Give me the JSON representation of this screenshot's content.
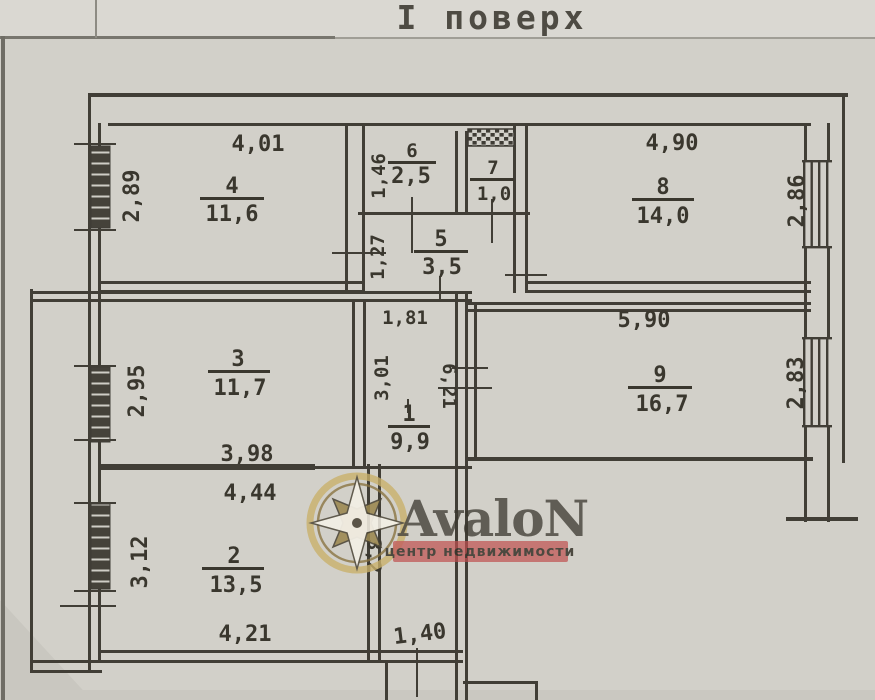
{
  "title": "І поверх",
  "floorplan": {
    "rooms": {
      "r1": {
        "num": "1",
        "area": "9,9"
      },
      "r2": {
        "num": "2",
        "area": "13,5"
      },
      "r3": {
        "num": "3",
        "area": "11,7"
      },
      "r4": {
        "num": "4",
        "area": "11,6"
      },
      "r5": {
        "num": "5",
        "area": "3,5"
      },
      "r6": {
        "num": "6",
        "area": "2,5"
      },
      "r7": {
        "num": "7",
        "area": "1,0"
      },
      "r8": {
        "num": "8",
        "area": "14,0"
      },
      "r9": {
        "num": "9",
        "area": "16,7"
      }
    },
    "dims": {
      "room4_top": "4,01",
      "room4_left": "2,89",
      "room6_left": "1,46",
      "room5_left": "1,27",
      "room8_top": "4,90",
      "room8_right": "2,86",
      "room3_left": "2,95",
      "room3_bottom": "3,98",
      "hall_top": "1,81",
      "hall_left": "3,01",
      "hall_right": "6,21",
      "room9_top": "5,90",
      "room9_right": "2,83",
      "room2_top": "4,44",
      "room2_left": "3,12",
      "room2_bottom": "4,21",
      "corridor_left": "3,2",
      "entry_width": "1,40"
    }
  },
  "watermark": {
    "brand": "AvaloN",
    "tagline": "центр недвижимости",
    "colors": {
      "brand_red": "#a34848",
      "banner_red": "#c05050",
      "gold": "#c9b06a"
    }
  }
}
